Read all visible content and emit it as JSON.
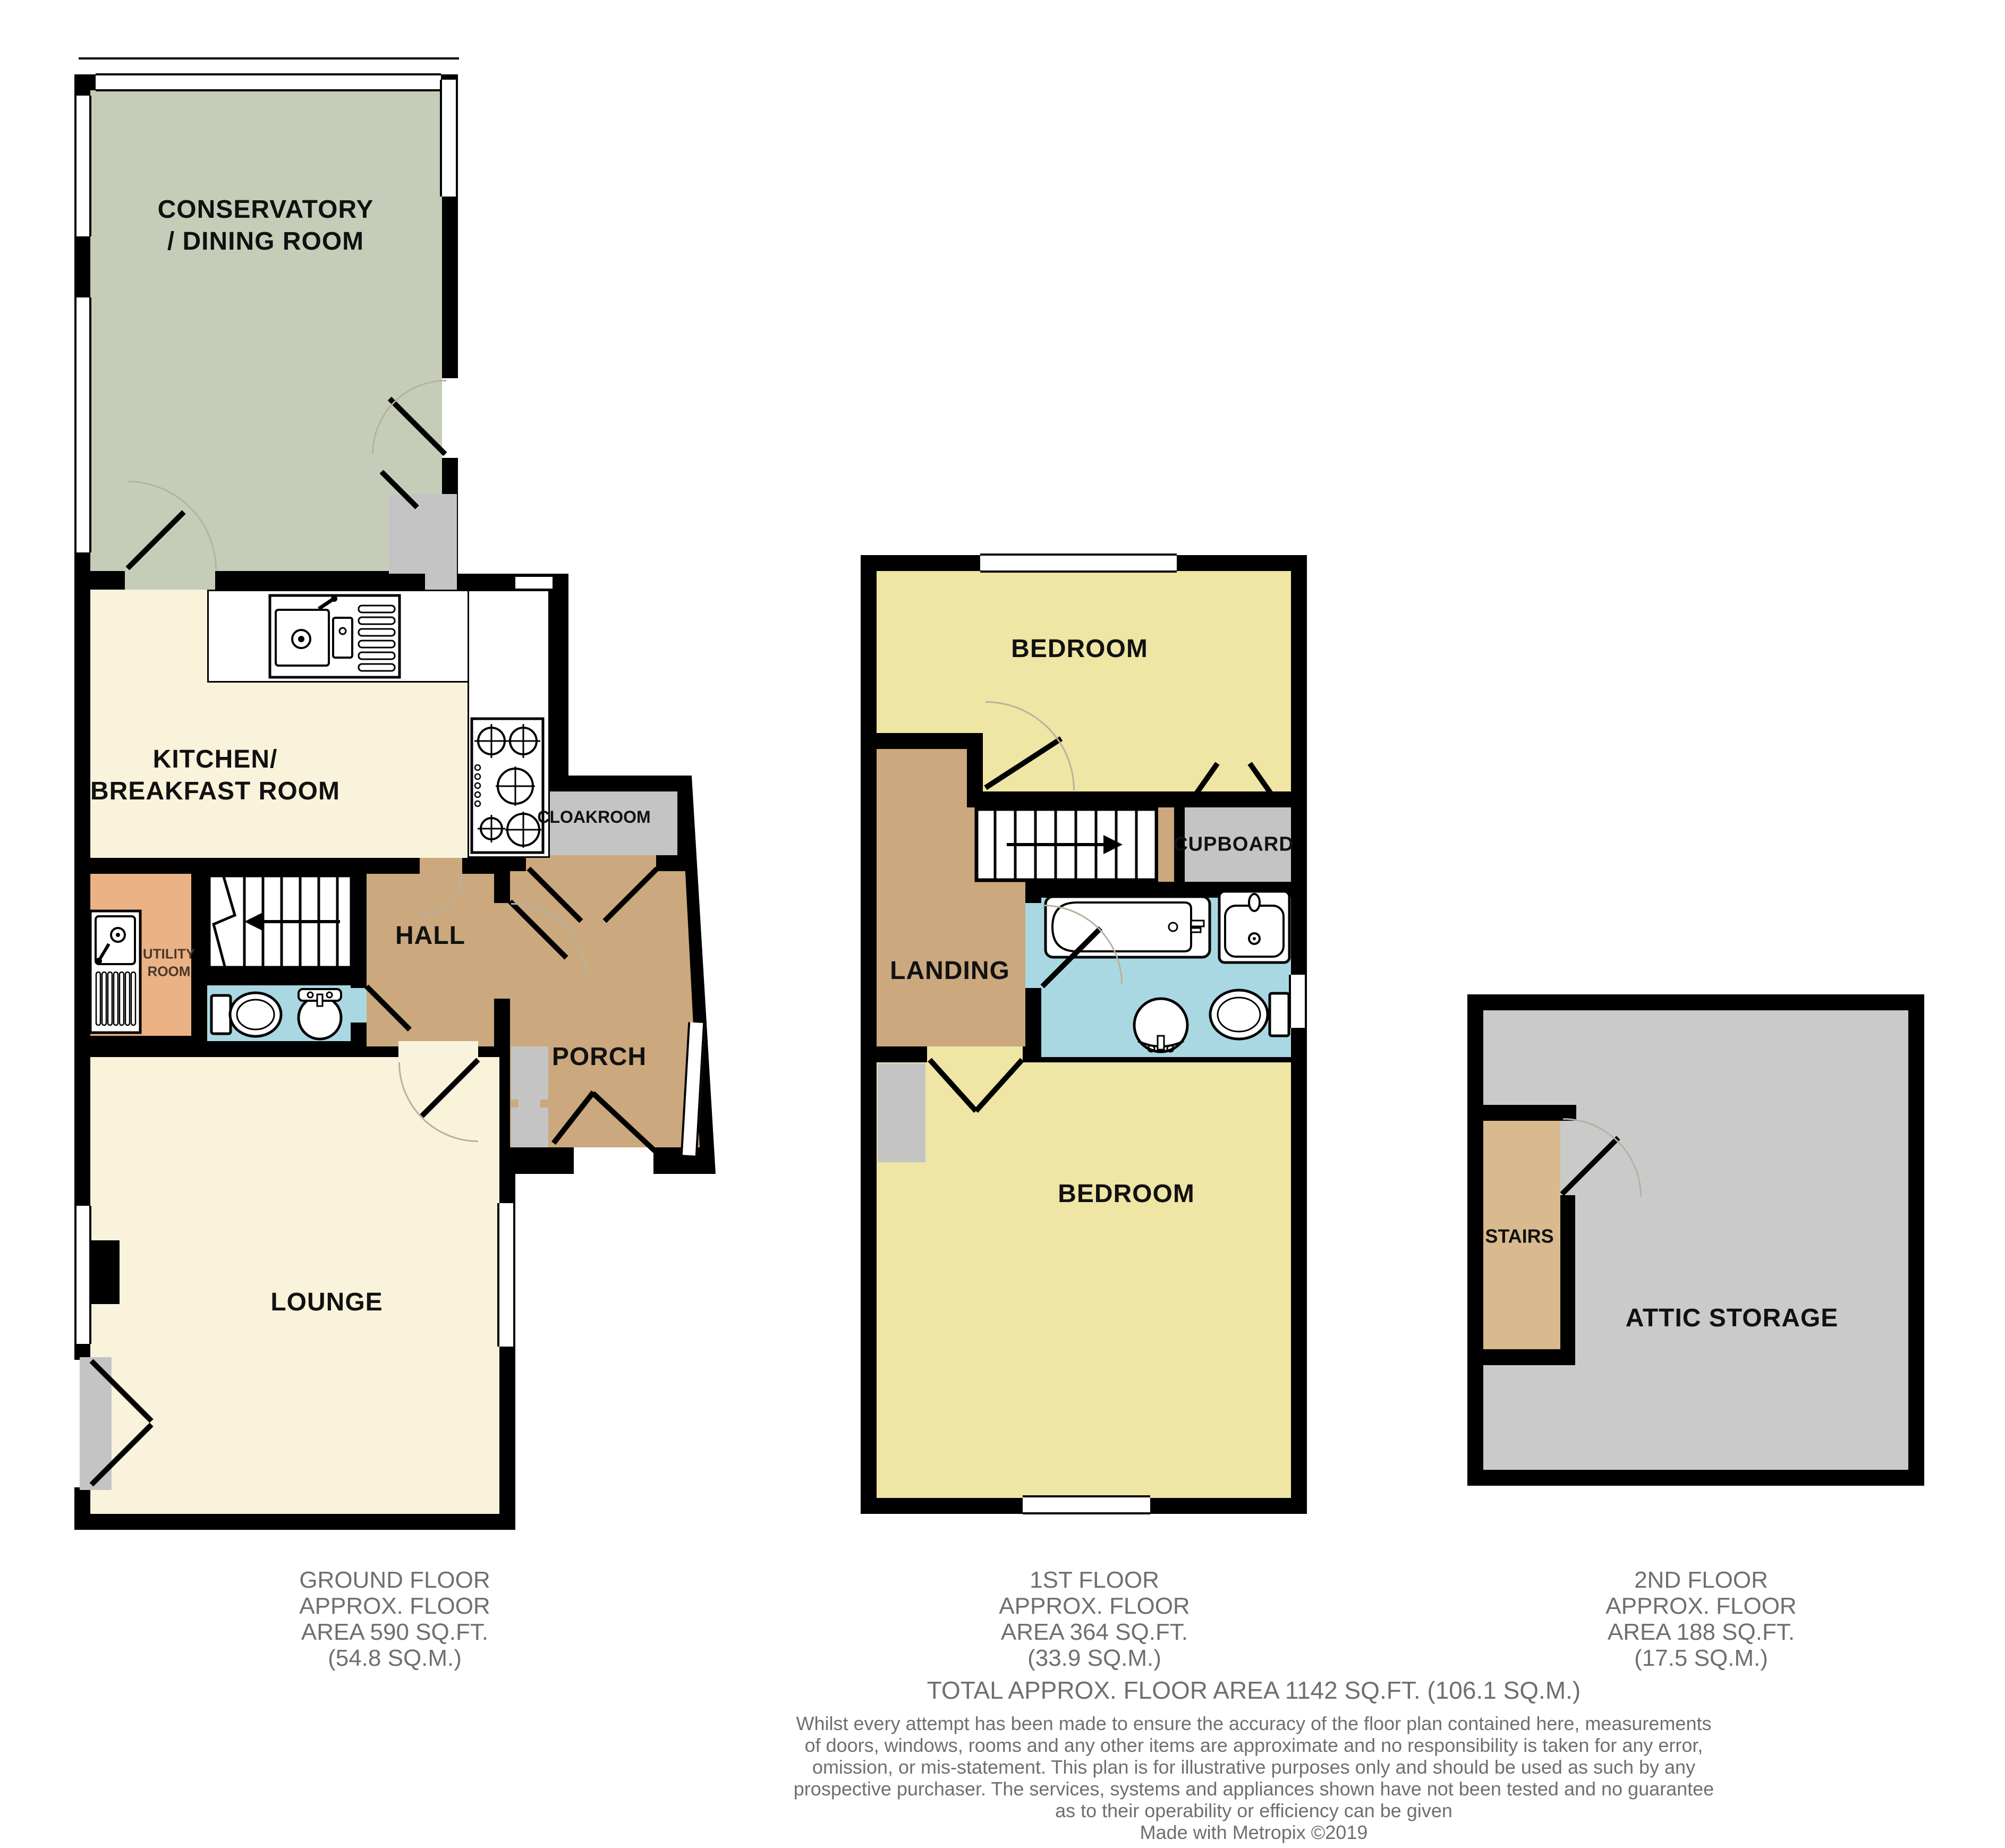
{
  "colors": {
    "wall": "#000000",
    "sage": "#c5cdb8",
    "cream": "#faf3dc",
    "tan": "#cba87d",
    "orange": "#ebb286",
    "blue": "#a9d8e3",
    "yellow": "#efe5a4",
    "gray": "#c4c4c4",
    "attic": "#cacaca",
    "stairs_tan": "#d9ba8e",
    "pad": "#c4c4c4",
    "footer_text": "#6f6f6f",
    "utility_text": "#4a3726",
    "arc": "#b8b19f"
  },
  "ground_floor": {
    "labels": {
      "conservatory": "CONSERVATORY\n/ DINING ROOM",
      "kitchen": "KITCHEN/\nBREAKFAST ROOM",
      "hall": "HALL",
      "cloakroom": "CLOAKROOM",
      "porch": "PORCH",
      "utility": "UTILITY\nROOM",
      "lounge": "LOUNGE"
    },
    "footer": [
      "GROUND FLOOR",
      "APPROX. FLOOR",
      "AREA 590 SQ.FT.",
      "(54.8 SQ.M.)"
    ]
  },
  "first_floor": {
    "labels": {
      "bedroom_front": "BEDROOM",
      "bedroom_back": "BEDROOM",
      "landing": "LANDING",
      "cupboard": "CUPBOARD"
    },
    "footer": [
      "1ST FLOOR",
      "APPROX. FLOOR",
      "AREA 364 SQ.FT.",
      "(33.9 SQ.M.)"
    ]
  },
  "second_floor": {
    "labels": {
      "stairs": "STAIRS",
      "attic": "ATTIC STORAGE"
    },
    "footer": [
      "2ND FLOOR",
      "APPROX. FLOOR",
      "AREA 188 SQ.FT.",
      "(17.5 SQ.M.)"
    ]
  },
  "summary": {
    "total": "TOTAL APPROX. FLOOR AREA 1142 SQ.FT. (106.1 SQ.M.)"
  },
  "disclaimer": {
    "lines": [
      "Whilst every attempt has been made to ensure the accuracy of the floor plan contained here, measurements",
      "of doors, windows, rooms and any other items are approximate and no responsibility is taken for any error,",
      "omission, or mis-statement. This plan is for illustrative purposes only and should be used as such by any",
      "prospective purchaser. The services, systems and appliances shown have not been tested and no guarantee",
      "as to their operability or efficiency can be given"
    ],
    "credit": "Made with Metropix ©2019"
  },
  "icons": {
    "kitchen-sink-icon": "double kitchen sink with drainer",
    "stove-icon": "gas hob with burners",
    "utility-sink-icon": "utility sink with drainer",
    "toilet-icon": "toilet pan with cistern",
    "basin-icon": "wash hand basin",
    "bath-icon": "bath tub with taps",
    "wall-sink-icon": "bathroom sink unit",
    "stairs-up-icon": "staircase with direction arrow"
  }
}
